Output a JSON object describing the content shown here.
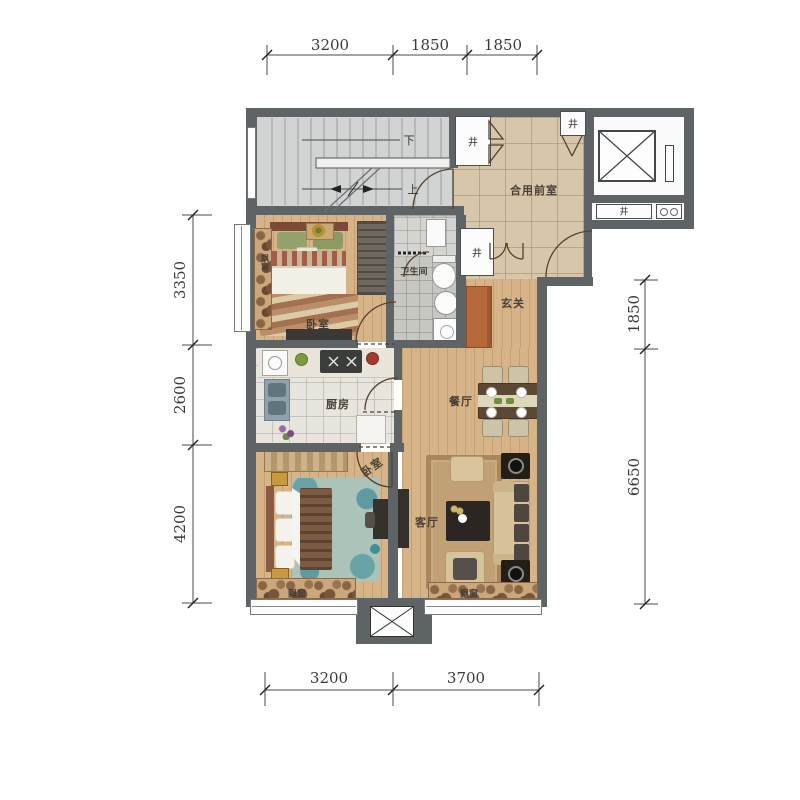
{
  "meta": {
    "type": "apartment-floor-plan"
  },
  "dim": {
    "top": [
      "3200",
      "1850",
      "1850"
    ],
    "bottom": [
      "3200",
      "3700"
    ],
    "left": [
      "3350",
      "2600",
      "4200"
    ],
    "right": [
      "1850",
      "6650"
    ]
  },
  "labels": {
    "front_room": "合用前室",
    "entrance": "玄关",
    "bathroom": "卫生间",
    "kitchen": "厨房",
    "dining": "餐厅",
    "living": "客厅",
    "bedroom": "卧室",
    "bay_window": "飘窗",
    "shaft": "井",
    "stairs_up": "上",
    "stairs_down": "下"
  },
  "colors": {
    "wall": "#5e6366",
    "wood_floor": "#d6b487",
    "front_room_tile": "#d8c6ab",
    "shoe_cabinet": "#b5683a",
    "living_rug": "#c1a075",
    "bedroom_rug": "#abc3b9"
  }
}
